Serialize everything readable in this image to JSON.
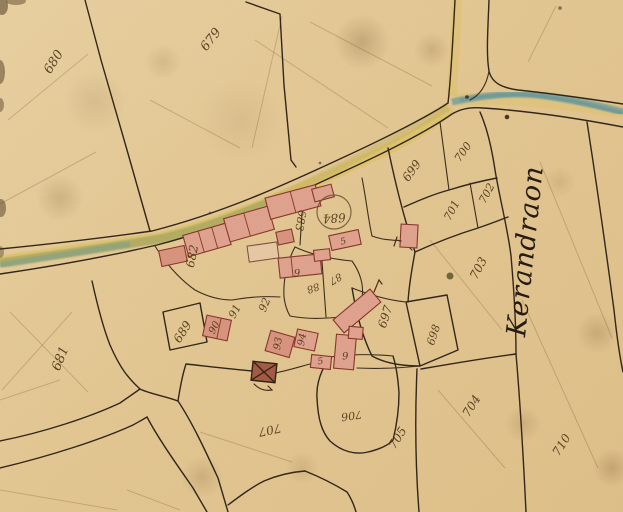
{
  "map": {
    "type": "historic-cadastral-map",
    "place_name": "Kerandraon",
    "colors": {
      "parchment": "#e4c994",
      "boundary_ink": "#2f2418",
      "building_fill": "#dfa28e",
      "building_stroke": "#86352a",
      "road_yellow": "#d9bf52",
      "stream_teal": "#6f9fa0",
      "number_ink": "#4a3416"
    },
    "symbols": [
      {
        "id": "crossed-building-icon",
        "meaning": "building marked with saltire cross"
      },
      {
        "id": "circled-parcel-icon",
        "meaning": "circle drawn around parcel 684"
      },
      {
        "id": "tree-icon",
        "meaning": "dark blob tree mark"
      }
    ],
    "labels": [
      {
        "id": "parcel-680",
        "text": "680"
      },
      {
        "id": "parcel-679",
        "text": "679"
      },
      {
        "id": "parcel-681",
        "text": "681"
      },
      {
        "id": "parcel-682",
        "text": "682"
      },
      {
        "id": "parcel-683",
        "text": "683"
      },
      {
        "id": "parcel-684",
        "text": "684"
      },
      {
        "id": "parcel-689",
        "text": "689"
      },
      {
        "id": "parcel-90",
        "text": "90"
      },
      {
        "id": "parcel-91",
        "text": "91"
      },
      {
        "id": "parcel-92",
        "text": "92"
      },
      {
        "id": "parcel-93",
        "text": "93"
      },
      {
        "id": "parcel-94",
        "text": "94"
      },
      {
        "id": "parcel-95",
        "text": "5"
      },
      {
        "id": "parcel-96",
        "text": "6"
      },
      {
        "id": "parcel-85",
        "text": "5"
      },
      {
        "id": "parcel-86",
        "text": "6"
      },
      {
        "id": "parcel-87",
        "text": "87"
      },
      {
        "id": "parcel-88",
        "text": "88"
      },
      {
        "id": "parcel-697",
        "text": "697"
      },
      {
        "id": "parcel-698",
        "text": "698"
      },
      {
        "id": "parcel-699",
        "text": "699"
      },
      {
        "id": "parcel-700",
        "text": "700"
      },
      {
        "id": "parcel-701",
        "text": "701"
      },
      {
        "id": "parcel-702",
        "text": "702"
      },
      {
        "id": "parcel-703",
        "text": "703"
      },
      {
        "id": "parcel-704",
        "text": "704"
      },
      {
        "id": "parcel-705",
        "text": "705"
      },
      {
        "id": "parcel-706",
        "text": "706"
      },
      {
        "id": "parcel-707",
        "text": "707"
      },
      {
        "id": "parcel-710",
        "text": "710"
      },
      {
        "id": "place-kerandraon",
        "text": "Kerandraon"
      }
    ]
  }
}
